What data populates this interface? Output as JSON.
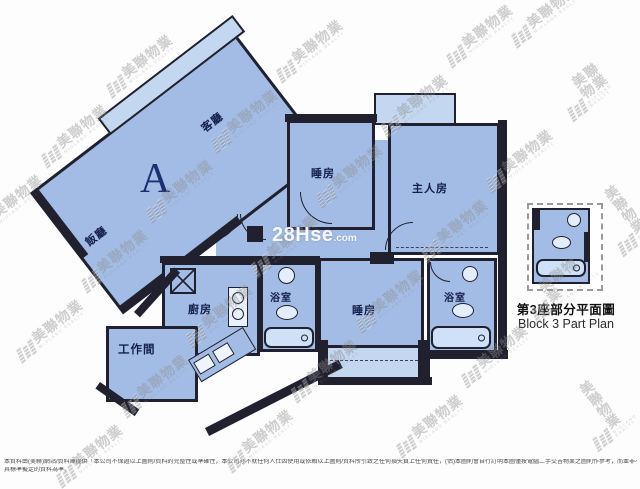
{
  "unit": {
    "label": "A"
  },
  "rooms": {
    "living": "客廳",
    "dining": "飯廳",
    "bedroom1": "睡房",
    "master_bedroom": "主人房",
    "bedroom2": "睡房",
    "kitchen": "廚房",
    "bathroom1": "浴室",
    "bathroom2": "浴室",
    "utility": "工作間"
  },
  "inset": {
    "caption_cn": "第3座部分平面圖",
    "caption_en": "Block 3 Part Plan"
  },
  "watermarks": {
    "midland_cn": "美聯物業",
    "midland_en": "MIDLAND REALTY",
    "center_site": "28Hse",
    "center_site_suffix": ".com"
  },
  "disclaimer": {
    "line1": "本資料由(美聯)網站/資料庫提供「本公司不保證以上圖則/資料的完整性或準確性，本公司亦不就任何人仕因使用或依賴以上圖則/資料所引致之任何損失負上任何責任，(估)本圖則會自行訂明本圖僅按電腦二手交吉物業之圖則作參考，而並非不可靠圖則擬繪製在一手交吉物業之準確。",
    "line2": "其標準擬定的資料為準。"
  },
  "colors": {
    "room_fill": "#a3bce6",
    "bay_fill": "#c3d7f0",
    "wall": "#20202e",
    "label_text": "#14204a",
    "unit_text": "#1d2f72",
    "wm_gray": "#8e8e8e"
  }
}
